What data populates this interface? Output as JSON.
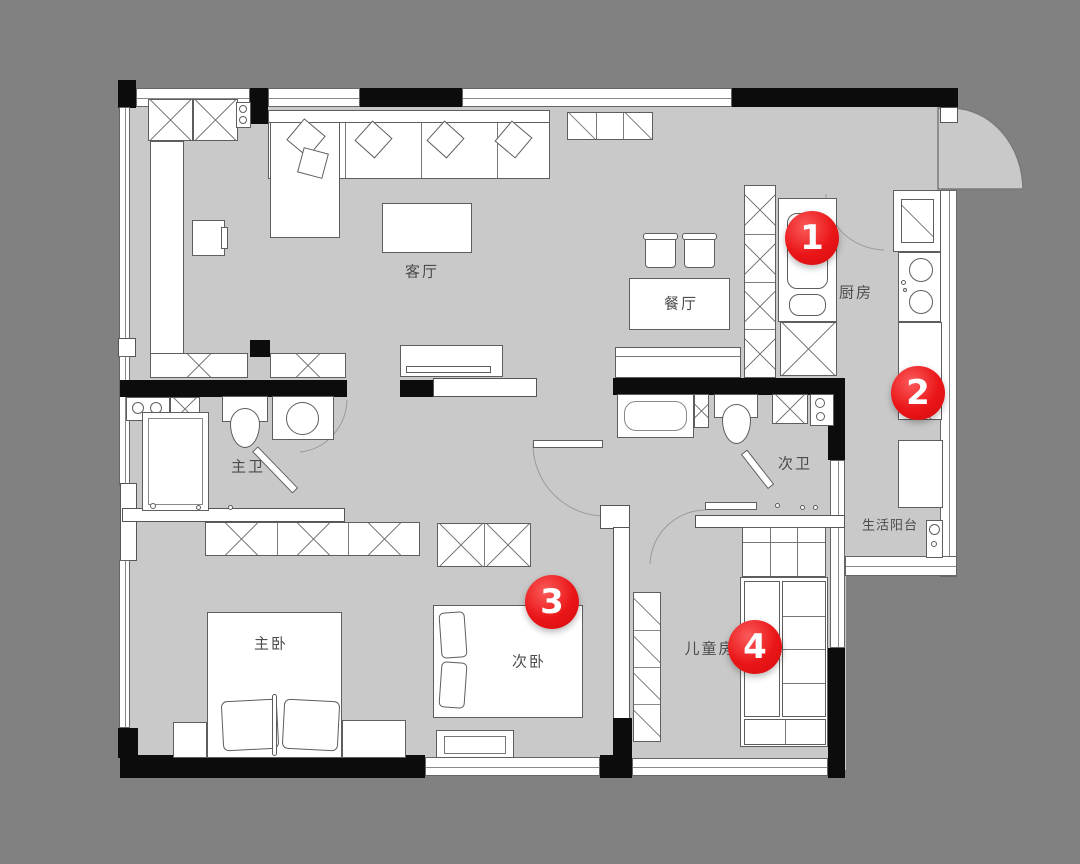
{
  "title": "apartment-floor-plan",
  "colors": {
    "background": "#818181",
    "floor": "#c9c9c9",
    "wall": "#0c0c0c",
    "marker": "#ea1517",
    "furniture": "#ffffff",
    "label_text": "#4c4c4c"
  },
  "rooms": {
    "living_room": "客厅",
    "dining_room": "餐厅",
    "kitchen": "厨房",
    "master_bath": "主卫",
    "second_bath": "次卫",
    "master_bedroom": "主卧",
    "second_bedroom": "次卧",
    "kids_room": "儿童房",
    "service_balcony": "生活阳台"
  },
  "markers": {
    "m1": "1",
    "m2": "2",
    "m3": "3",
    "m4": "4"
  }
}
